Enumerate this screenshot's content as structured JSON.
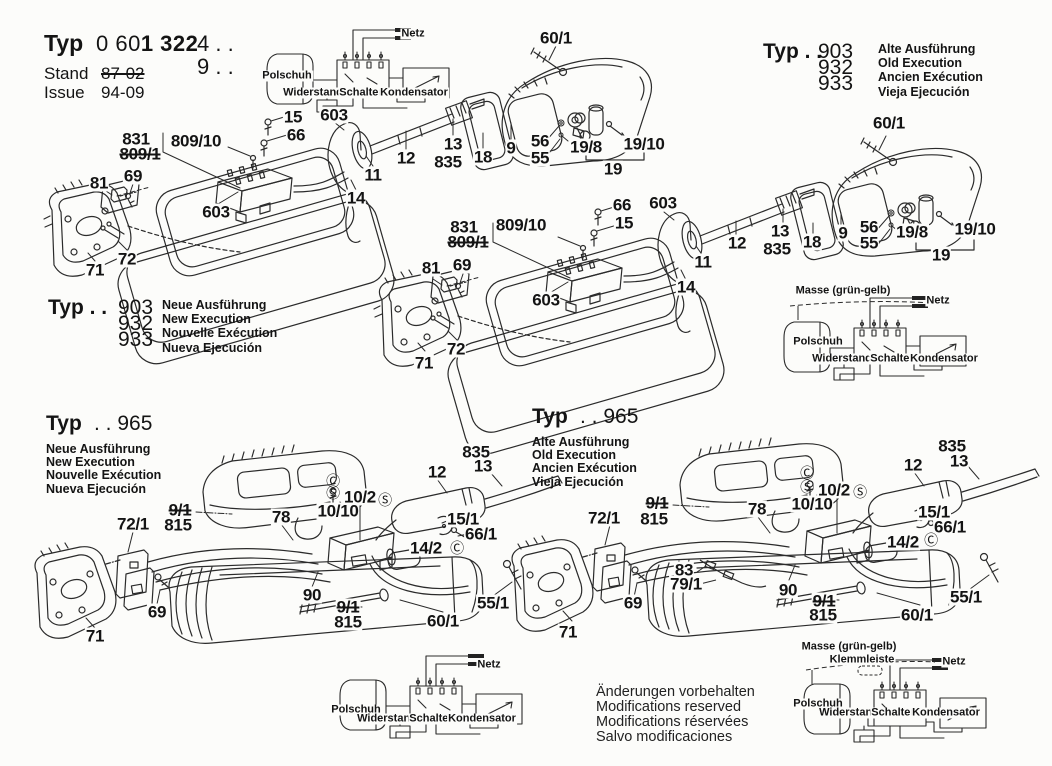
{
  "header": {
    "typ_label": "Typ",
    "code_light": "0 60",
    "code_bold": "1 322",
    "suffix1": "4 . .",
    "suffix2": "9 . .",
    "stand_label": "Stand",
    "stand_value": "87-02",
    "issue_label": "Issue",
    "issue_value": "94-09"
  },
  "blocks": [
    {
      "typ": "Typ . .",
      "nums": [
        "903",
        "932",
        "933"
      ],
      "langs": [
        "Alte Ausführung",
        "Old Execution",
        "Ancien Exécution",
        "Vieja Ejecución"
      ]
    },
    {
      "typ": "Typ . .",
      "nums": [
        "903",
        "932",
        "933"
      ],
      "langs": [
        "Neue Ausführung",
        "New Execution",
        "Nouvelle Exécution",
        "Nueva Ejecución"
      ]
    },
    {
      "typ": "Typ",
      "nums": [
        ". . 965"
      ],
      "langs": [
        "Neue Ausführung",
        "New Execution",
        "Nouvelle Exécution",
        "Nueva Ejecución"
      ]
    },
    {
      "typ": "Typ",
      "nums": [
        ". . 965"
      ],
      "langs": [
        "Alte Ausführung",
        "Old Execution",
        "Ancien Exécution",
        "Vieja Ejecución"
      ]
    }
  ],
  "footer_note": [
    "Änderungen vorbehalten",
    "Modifications reserved",
    "Modifications réservées",
    "Salvo modificaciones"
  ],
  "part_labels": [
    {
      "t": "60/1",
      "x": 556,
      "y": 38
    },
    {
      "t": "15",
      "x": 293,
      "y": 117
    },
    {
      "t": "66",
      "x": 296,
      "y": 135
    },
    {
      "t": "603",
      "x": 334,
      "y": 115
    },
    {
      "t": "831",
      "x": 136,
      "y": 139
    },
    {
      "t": "809/10",
      "x": 196,
      "y": 141
    },
    {
      "t": "809/1",
      "x": 140,
      "y": 154,
      "k": "struck"
    },
    {
      "t": "81",
      "x": 99,
      "y": 183
    },
    {
      "t": "69",
      "x": 133,
      "y": 176
    },
    {
      "t": "603",
      "x": 216,
      "y": 212
    },
    {
      "t": "71",
      "x": 95,
      "y": 270
    },
    {
      "t": "72",
      "x": 127,
      "y": 259
    },
    {
      "t": "12",
      "x": 406,
      "y": 158
    },
    {
      "t": "13",
      "x": 453,
      "y": 144
    },
    {
      "t": "835",
      "x": 448,
      "y": 162
    },
    {
      "t": "18",
      "x": 483,
      "y": 157
    },
    {
      "t": "9",
      "x": 511,
      "y": 148
    },
    {
      "t": "56",
      "x": 540,
      "y": 141
    },
    {
      "t": "55",
      "x": 540,
      "y": 158
    },
    {
      "t": "19/8",
      "x": 586,
      "y": 147
    },
    {
      "t": "19/10",
      "x": 644,
      "y": 144
    },
    {
      "t": "19",
      "x": 613,
      "y": 169
    },
    {
      "t": "11",
      "x": 373,
      "y": 175
    },
    {
      "t": "14",
      "x": 356,
      "y": 198
    },
    {
      "t": "66",
      "x": 622,
      "y": 205
    },
    {
      "t": "15",
      "x": 624,
      "y": 223
    },
    {
      "t": "603",
      "x": 663,
      "y": 203
    },
    {
      "t": "831",
      "x": 464,
      "y": 227
    },
    {
      "t": "809/10",
      "x": 521,
      "y": 225
    },
    {
      "t": "809/1",
      "x": 468,
      "y": 242,
      "k": "struck"
    },
    {
      "t": "69",
      "x": 462,
      "y": 265
    },
    {
      "t": "81",
      "x": 431,
      "y": 268
    },
    {
      "t": "603",
      "x": 546,
      "y": 300
    },
    {
      "t": "11",
      "x": 703,
      "y": 262
    },
    {
      "t": "14",
      "x": 686,
      "y": 287
    },
    {
      "t": "71",
      "x": 424,
      "y": 363
    },
    {
      "t": "72",
      "x": 456,
      "y": 349
    },
    {
      "t": "12",
      "x": 737,
      "y": 243
    },
    {
      "t": "13",
      "x": 780,
      "y": 231
    },
    {
      "t": "835",
      "x": 777,
      "y": 249
    },
    {
      "t": "18",
      "x": 812,
      "y": 242
    },
    {
      "t": "9",
      "x": 843,
      "y": 233
    },
    {
      "t": "56",
      "x": 869,
      "y": 227
    },
    {
      "t": "55",
      "x": 869,
      "y": 243
    },
    {
      "t": "19/8",
      "x": 912,
      "y": 232
    },
    {
      "t": "19/10",
      "x": 975,
      "y": 229
    },
    {
      "t": "19",
      "x": 941,
      "y": 255
    },
    {
      "t": "60/1",
      "x": 889,
      "y": 123
    },
    {
      "t": "835",
      "x": 476,
      "y": 452
    },
    {
      "t": "13",
      "x": 483,
      "y": 466
    },
    {
      "t": "12",
      "x": 437,
      "y": 472
    },
    {
      "t": "Ⓒ",
      "x": 333,
      "y": 481,
      "k": "circ"
    },
    {
      "t": "Ⓢ",
      "x": 333,
      "y": 493,
      "k": "circ"
    },
    {
      "t": "10/2",
      "x": 360,
      "y": 497
    },
    {
      "t": "Ⓢ",
      "x": 385,
      "y": 500,
      "k": "circ"
    },
    {
      "t": "10/10",
      "x": 338,
      "y": 511
    },
    {
      "t": "78",
      "x": 281,
      "y": 517
    },
    {
      "t": "15/1",
      "x": 463,
      "y": 519
    },
    {
      "t": "66/1",
      "x": 481,
      "y": 534
    },
    {
      "t": "14/2",
      "x": 426,
      "y": 548
    },
    {
      "t": "Ⓒ",
      "x": 457,
      "y": 548,
      "k": "circ"
    },
    {
      "t": "9/1",
      "x": 180,
      "y": 510,
      "k": "struck"
    },
    {
      "t": "815",
      "x": 178,
      "y": 525
    },
    {
      "t": "72/1",
      "x": 133,
      "y": 524
    },
    {
      "t": "69",
      "x": 157,
      "y": 612
    },
    {
      "t": "90",
      "x": 312,
      "y": 595
    },
    {
      "t": "9/1",
      "x": 348,
      "y": 607,
      "k": "struck"
    },
    {
      "t": "815",
      "x": 348,
      "y": 622
    },
    {
      "t": "60/1",
      "x": 443,
      "y": 621
    },
    {
      "t": "55/1",
      "x": 493,
      "y": 603
    },
    {
      "t": "71",
      "x": 95,
      "y": 636
    },
    {
      "t": "835",
      "x": 952,
      "y": 446
    },
    {
      "t": "13",
      "x": 959,
      "y": 461
    },
    {
      "t": "12",
      "x": 913,
      "y": 465
    },
    {
      "t": "Ⓒ",
      "x": 807,
      "y": 473,
      "k": "circ"
    },
    {
      "t": "Ⓢ",
      "x": 807,
      "y": 487,
      "k": "circ"
    },
    {
      "t": "10/2",
      "x": 834,
      "y": 490
    },
    {
      "t": "Ⓢ",
      "x": 860,
      "y": 492,
      "k": "circ"
    },
    {
      "t": "10/10",
      "x": 812,
      "y": 504
    },
    {
      "t": "78",
      "x": 757,
      "y": 509
    },
    {
      "t": "15/1",
      "x": 934,
      "y": 512
    },
    {
      "t": "66/1",
      "x": 950,
      "y": 527
    },
    {
      "t": "14/2",
      "x": 903,
      "y": 542
    },
    {
      "t": "Ⓒ",
      "x": 931,
      "y": 540,
      "k": "circ"
    },
    {
      "t": "9/1",
      "x": 657,
      "y": 503,
      "k": "struck"
    },
    {
      "t": "815",
      "x": 654,
      "y": 519
    },
    {
      "t": "72/1",
      "x": 604,
      "y": 518
    },
    {
      "t": "83",
      "x": 684,
      "y": 570
    },
    {
      "t": "79/1",
      "x": 686,
      "y": 584
    },
    {
      "t": "90",
      "x": 788,
      "y": 590
    },
    {
      "t": "9/1",
      "x": 824,
      "y": 601,
      "k": "struck"
    },
    {
      "t": "815",
      "x": 823,
      "y": 615
    },
    {
      "t": "69",
      "x": 633,
      "y": 603
    },
    {
      "t": "71",
      "x": 568,
      "y": 632
    },
    {
      "t": "60/1",
      "x": 917,
      "y": 615
    },
    {
      "t": "55/1",
      "x": 966,
      "y": 597
    }
  ],
  "wiring_labels": [
    {
      "t": "Netz",
      "x": 413,
      "y": 34
    },
    {
      "t": "Polschuh",
      "x": 287,
      "y": 76
    },
    {
      "t": "Widerstand",
      "x": 313,
      "y": 93
    },
    {
      "t": "Schalter",
      "x": 361,
      "y": 93
    },
    {
      "t": "Kondensator",
      "x": 414,
      "y": 93
    },
    {
      "t": "Masse (grün-gelb)",
      "x": 843,
      "y": 291
    },
    {
      "t": "Netz",
      "x": 938,
      "y": 301
    },
    {
      "t": "Polschuh",
      "x": 818,
      "y": 342
    },
    {
      "t": "Widerstand",
      "x": 842,
      "y": 359
    },
    {
      "t": "Schalter",
      "x": 892,
      "y": 359
    },
    {
      "t": "Kondensator",
      "x": 944,
      "y": 359
    },
    {
      "t": "Netz",
      "x": 489,
      "y": 665
    },
    {
      "t": "Polschuh",
      "x": 356,
      "y": 710
    },
    {
      "t": "Widerstand",
      "x": 387,
      "y": 719
    },
    {
      "t": "Schalter",
      "x": 431,
      "y": 719
    },
    {
      "t": "Kondensator",
      "x": 482,
      "y": 719
    },
    {
      "t": "Masse (grün-gelb)",
      "x": 849,
      "y": 647
    },
    {
      "t": "Klemmleiste",
      "x": 862,
      "y": 660
    },
    {
      "t": "Netz",
      "x": 954,
      "y": 662
    },
    {
      "t": "Polschuh",
      "x": 818,
      "y": 704
    },
    {
      "t": "Widerstand",
      "x": 849,
      "y": 713
    },
    {
      "t": "Schalter",
      "x": 893,
      "y": 713
    },
    {
      "t": "Kondensator",
      "x": 946,
      "y": 713
    }
  ]
}
